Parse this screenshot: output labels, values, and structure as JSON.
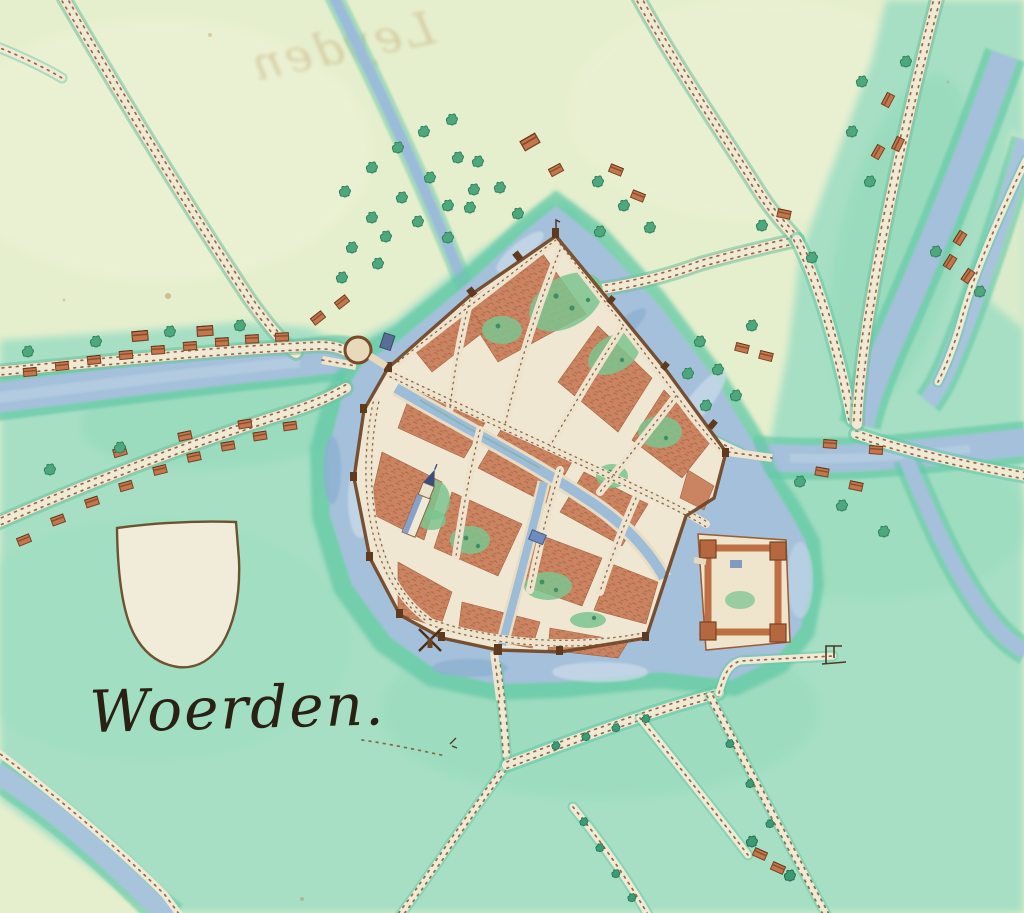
{
  "map": {
    "town_label": "Woerden.",
    "ghost_text": "Leyden",
    "features": {
      "shield": "blank-heraldic-shield",
      "castle": "castle-with-corner-towers",
      "church": "church-with-spire",
      "windmill": "post-mill-on-south-wall",
      "moat": "town-moat",
      "west_river": "river-west",
      "east_river": "river-east",
      "roads": "stippled-roads",
      "houses": "roadside-houses",
      "trees": "tree-clusters"
    },
    "palette": {
      "field_pale": "#e6efcd",
      "meadow_mint": "#a6dfc4",
      "teal_fringe": "#62c8a5",
      "water_blue": "#a4c0da",
      "road_cream": "#f2e9d5",
      "building_terracotta": "#c9815e",
      "wall_brown": "#6e4322",
      "ink": "#2a2014"
    }
  }
}
